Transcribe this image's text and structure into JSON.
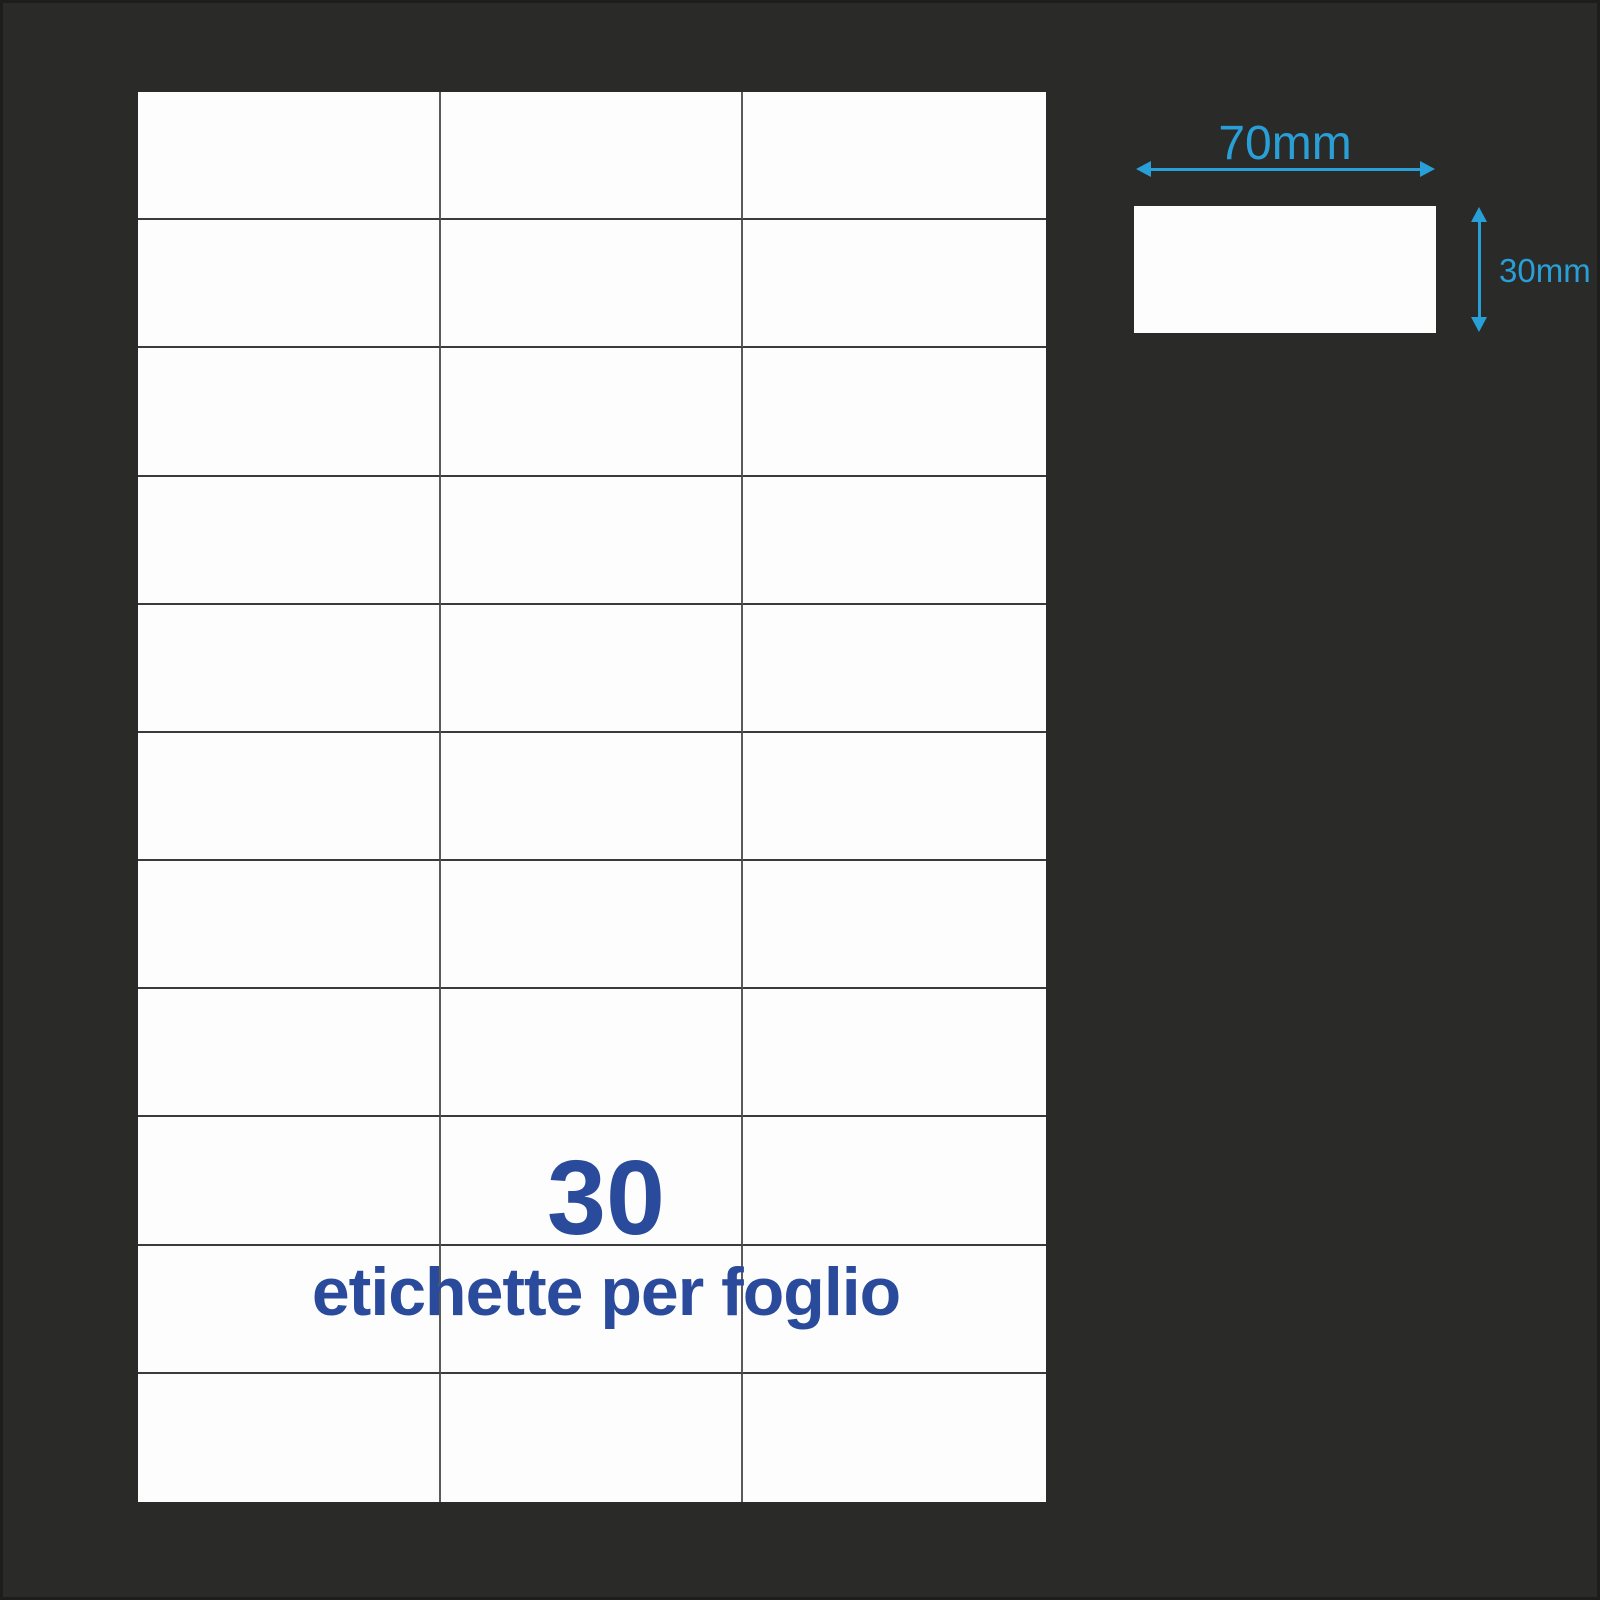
{
  "sheet": {
    "columns": 3,
    "rows": 11,
    "count_label": "30",
    "caption": "etichette per foglio"
  },
  "dimension_diagram": {
    "width_label": "70mm",
    "height_label": "30mm"
  },
  "colors": {
    "background": "#2A2A28",
    "edge": "#1D1D1D",
    "sheet_white": "#FDFDFD",
    "grid_line_horizontal": "#3B3B3B",
    "grid_line_vertical": "#5A5A5A",
    "accent_blue": "#2A4A9B",
    "accent_cyan": "#299FD8"
  }
}
